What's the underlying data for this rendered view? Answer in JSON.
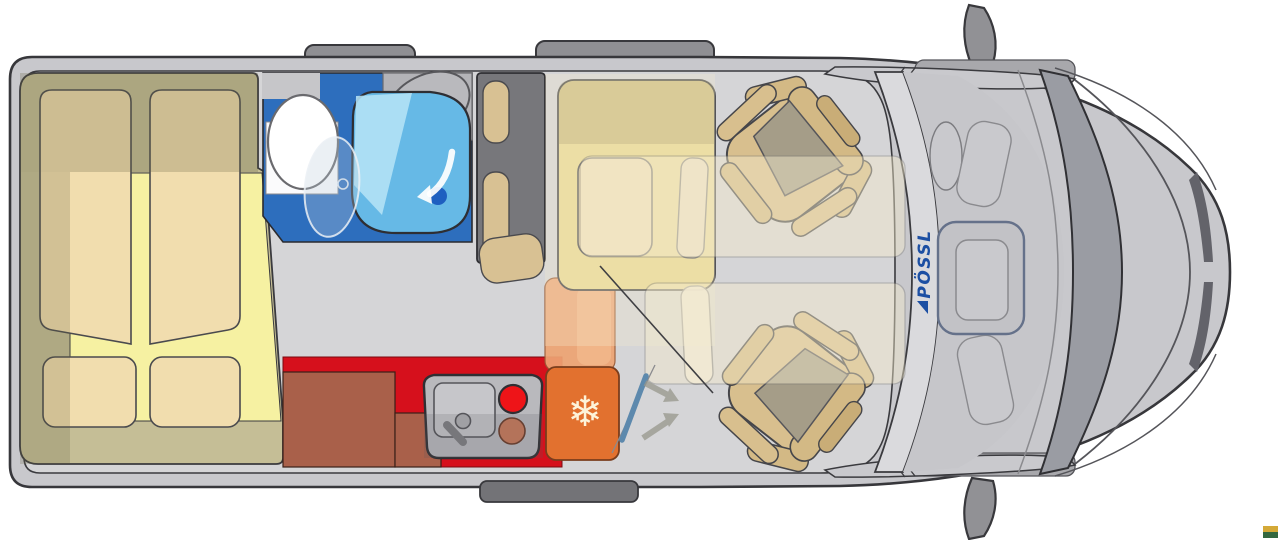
{
  "title": "Campervan top-view floor plan",
  "branding": {
    "logo_text": "PÖSSL",
    "logo_color": "#1c4fa3"
  },
  "icons": {
    "snowflake_glyph": "❄",
    "snowflake_icon": "fridge-snowflake",
    "shower_arrow_icon": "white curved arrow in shower tray",
    "swivel_arrow_icon": "two gray arrows at sliding door"
  },
  "areas": {
    "rear_bed": "transverse rear bed with four cushions",
    "bathroom": "wet bath with toilet, washbasin and shower tray",
    "wardrobe": "wardrobe column with two cushions",
    "kitchen": "red kitchen block with sink, two burners and cabinets",
    "fridge": "compressor fridge with snowflake symbol",
    "dinette": "bench with table and two bed overlays",
    "cab": "two swivelled cab seats, dashboard, windshield, hood, mirrors"
  },
  "colors": {
    "body_gray": "#c8c8cc",
    "outline_dark": "#38383c",
    "floor_gray": "#d5d5d7",
    "bed_platform_khaki": "#c5be96",
    "mattress_yellow": "#f6f1a2",
    "cushion_tan": "#f1ddae",
    "bath_blue": "#2d6ebd",
    "shower_blue": "#66b9e6",
    "shower_light": "#b5e2f6",
    "drain_blue": "#1e5fc0",
    "wardrobe_gray": "#77777b",
    "pill_tan": "#d8c193",
    "kitchen_red": "#d6101c",
    "cabinet_brown": "#a9604a",
    "unit_gray": "#b9b9bd",
    "burner_red": "#ee1418",
    "burner_orange": "#c8795a",
    "fridge_orange": "#e2712f",
    "fridge_salmon": "#eda473",
    "bench_yellow": "#e9d894",
    "seat_tan": "#d8bf8e",
    "seat_pill": "#d3b985",
    "seat_cushion_gray": "#a59d88",
    "bed_overlay_beige": "#f4ebcd",
    "windshield_gray": "#9a9ca3",
    "logo_blue": "#1c4fa3",
    "snowflake_cream": "#fdf3d9",
    "mark_gold": "#d4a937",
    "mark_green": "#33673f"
  }
}
